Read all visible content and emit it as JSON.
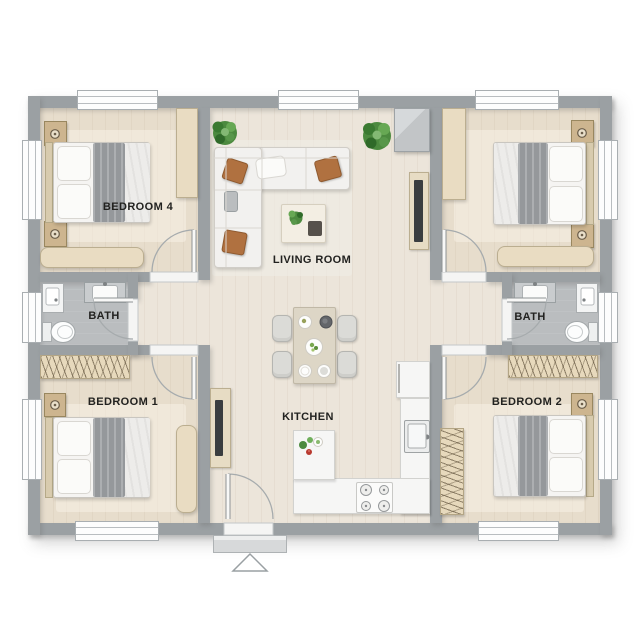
{
  "floor_plan": {
    "rooms": [
      {
        "name": "bedroom-4",
        "label": "BEDROOM 4",
        "furniture": [
          "double-bed",
          "nightstand",
          "nightstand",
          "wardrobe",
          "bench"
        ]
      },
      {
        "name": "living-room",
        "label": "LIVING ROOM",
        "furniture": [
          "corner-sofa",
          "coffee-table",
          "tv-unit",
          "media-cabinet",
          "plant",
          "plant"
        ]
      },
      {
        "name": "bath-left",
        "label": "BATH",
        "furniture": [
          "vanity-sink",
          "shower",
          "toilet"
        ]
      },
      {
        "name": "bath-right",
        "label": "BATH",
        "furniture": [
          "vanity-sink",
          "shower",
          "toilet"
        ]
      },
      {
        "name": "bedroom-1",
        "label": "BEDROOM 1",
        "furniture": [
          "double-bed",
          "nightstand",
          "closet-hangers",
          "bench"
        ]
      },
      {
        "name": "kitchen",
        "label": "KITCHEN",
        "furniture": [
          "l-shaped-counter",
          "stove",
          "sink",
          "fridge",
          "dining-table",
          "chairs"
        ]
      },
      {
        "name": "bedroom-2",
        "label": "BEDROOM 2",
        "furniture": [
          "double-bed",
          "nightstand",
          "closet-hangers",
          "wardrobe"
        ]
      },
      {
        "name": "bedroom-top-right",
        "label": "",
        "furniture": [
          "double-bed",
          "nightstand",
          "nightstand",
          "wardrobe",
          "bench"
        ]
      }
    ],
    "entrance": {
      "marker": "triangle-up-arrow",
      "position": "bottom-center"
    },
    "colors": {
      "wall": "#9ba0a3",
      "floor_wood": "#ece5da",
      "floor_wood_bedroom": "#e7ddcc",
      "floor_bath": "#babdbf",
      "furniture_white": "#f5f4f2",
      "furniture_tan": "#e9dcc2",
      "blanket_gray": "#95989b",
      "accent_pillow": "#b07140",
      "plant_green": "#4c8a3f"
    }
  }
}
